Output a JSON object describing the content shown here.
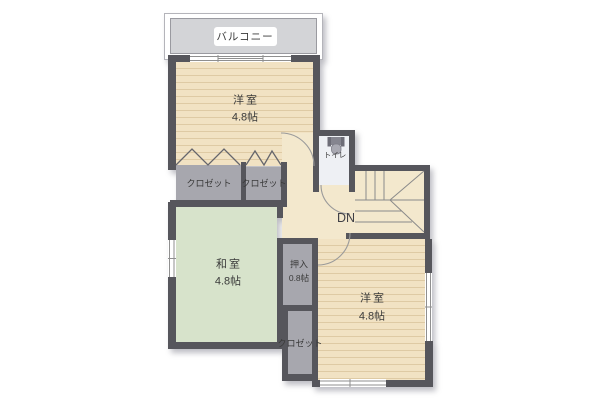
{
  "plan": {
    "balcony": {
      "label": "バルコニー"
    },
    "western_room_top": {
      "label": "洋室",
      "size": "4.8帖"
    },
    "closet_top_left": {
      "label": "クロゼット"
    },
    "closet_top_right": {
      "label": "クロゼット"
    },
    "toilet": {
      "label": "トイレ"
    },
    "stairs": {
      "label": "DN"
    },
    "japanese_room": {
      "label": "和室",
      "size": "4.8帖"
    },
    "oshiire": {
      "label": "押入",
      "size": "0.8帖"
    },
    "closet_bottom": {
      "label": "クロゼット"
    },
    "western_room_bottom": {
      "label": "洋室",
      "size": "4.8帖"
    }
  },
  "colors": {
    "wood": "#f1e2c3",
    "wood_stripe": "#decaa4",
    "hall": "#f3e8cd",
    "tatami": "#d7e3cb",
    "closet": "#a7a7ae",
    "toilet_floor": "#eef0f4",
    "balcony": "#d3d4d7",
    "wall": "#56565c",
    "text": "#3a3a3a",
    "line": "#8f8f8f"
  }
}
